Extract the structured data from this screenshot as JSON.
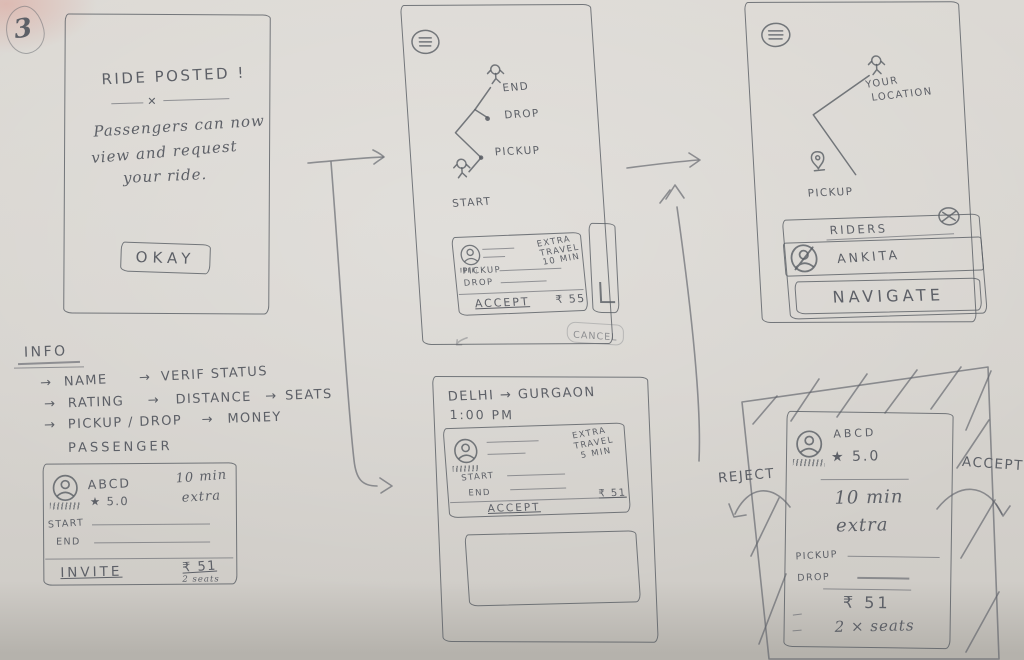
{
  "page": {
    "number": "3"
  },
  "flow": {
    "screen_posted": {
      "title": "RIDE POSTED !",
      "divider_mark": "✕",
      "body_line1": "Passengers can now",
      "body_line2": "view and request",
      "body_line3": "your ride.",
      "okay_label": "OKAY"
    },
    "screen_driver_map": {
      "label_end": "END",
      "label_drop": "DROP",
      "label_pickup": "PICKUP",
      "label_start": "START",
      "request_card": {
        "extra_line1": "EXTRA",
        "extra_line2": "TRAVEL",
        "extra_line3": "10 MIN",
        "pickup_label": "PICKUP",
        "drop_label": "DROP",
        "accept_label": "ACCEPT",
        "price": "₹ 55"
      },
      "cancel_label": "CANCEL"
    },
    "screen_navigate": {
      "label_your_location_1": "YOUR",
      "label_your_location_2": "LOCATION",
      "label_pickup": "PICKUP",
      "riders_panel": {
        "title": "RIDERS",
        "rider_name": "ANKITA",
        "navigate_label": "NAVIGATE"
      }
    },
    "screen_ride_detail": {
      "route": "DELHI → GURGAON",
      "time": "1:00 PM",
      "request_card": {
        "extra_line1": "EXTRA",
        "extra_line2": "TRAVEL",
        "extra_line3": "5 MIN",
        "start_label": "START",
        "end_label": "END",
        "accept_label": "ACCEPT",
        "price": "₹ 51"
      }
    },
    "screen_request_modal": {
      "reject_label": "REJECT",
      "accept_label": "ACCEPT",
      "card": {
        "name": "ABCD",
        "rating": "★ 5.0",
        "extra_line1": "10 min",
        "extra_line2": "extra",
        "pickup_label": "PICKUP",
        "drop_label": "DROP",
        "price": "₹ 51",
        "seats": "2 × seats"
      }
    }
  },
  "info_notes": {
    "title": "INFO",
    "arrow": "→",
    "row1": [
      "NAME",
      "VERIF STATUS"
    ],
    "row2": [
      "RATING",
      "DISTANCE",
      "SEATS"
    ],
    "row3": [
      "PICKUP / DROP",
      "MONEY"
    ]
  },
  "passenger_card": {
    "title": "PASSENGER",
    "name": "ABCD",
    "rating": "★ 5.0",
    "extra_line1": "10 min",
    "extra_line2": "extra",
    "start_label": "START",
    "end_label": "END",
    "invite_label": "INVITE",
    "price": "₹ 51",
    "seats": "2 seats"
  }
}
